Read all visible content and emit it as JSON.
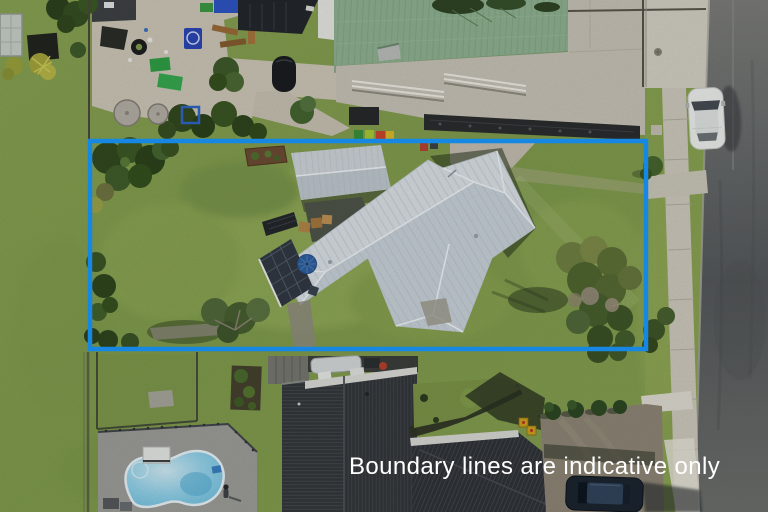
{
  "image": {
    "type": "aerial-property-photo",
    "width": 768,
    "height": 512
  },
  "overlay": {
    "caption": "Boundary lines are indicative only",
    "caption_color": "#ffffff",
    "boundary_color": "#1687e2",
    "boundary_stroke_px": 4.5
  },
  "scene": {
    "labels": [
      "kindergarten playground",
      "green-roofed hall",
      "concrete courtyard",
      "street with parked white car",
      "footpath",
      "fenced property lawn",
      "main house with light grey roof",
      "garage shed",
      "solar panel deck with blue umbrella",
      "mature trees",
      "neighbouring dark-roofed house",
      "empty swimming pool",
      "gravel driveway with parked dark car"
    ],
    "palette": {
      "lawn": "#829c4e",
      "concrete": "#c5c1b5",
      "main_roof": "#d9dfe4",
      "garage_roof": "#cdd3d8",
      "green_roof": "#8fb091",
      "dark_roof": "#33373b",
      "road": "#5f6263",
      "pool_water": "#8ed1e8",
      "tree_dark": "#32491f",
      "white_car": "#ebedeb"
    }
  }
}
